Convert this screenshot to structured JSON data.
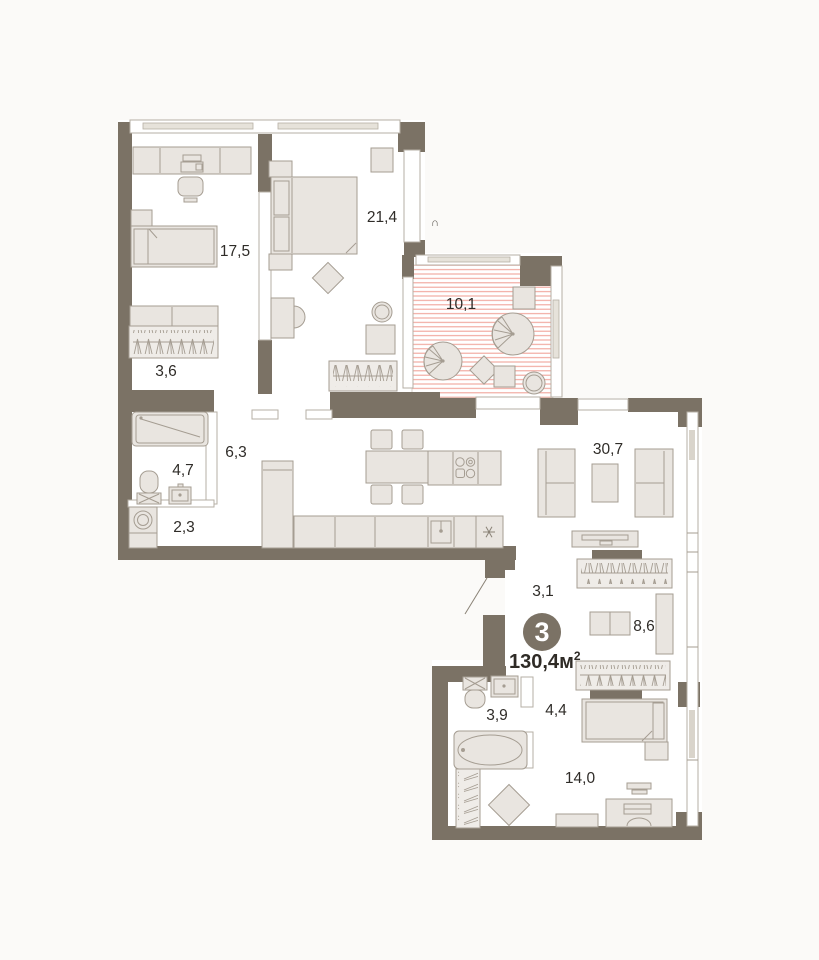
{
  "page": {
    "background": "#fbfaf8"
  },
  "plan": {
    "type": "apartment-floor-plan",
    "badge": {
      "rooms_count": "3",
      "area_value": "130,4",
      "area_unit": "м",
      "area_sup": "2"
    },
    "rooms": [
      {
        "id": "bedroom-kids",
        "area": "17,5"
      },
      {
        "id": "bedroom-master",
        "area": "21,4"
      },
      {
        "id": "wardrobe-kids",
        "area": "3,6"
      },
      {
        "id": "balcony",
        "area": "10,1"
      },
      {
        "id": "hallway",
        "area": "6,3"
      },
      {
        "id": "bathroom-main",
        "area": "4,7"
      },
      {
        "id": "laundry",
        "area": "2,3"
      },
      {
        "id": "living-kitchen",
        "area": "30,7"
      },
      {
        "id": "corridor",
        "area": "3,1"
      },
      {
        "id": "wardrobe-hall",
        "area": "8,6"
      },
      {
        "id": "bathroom-second",
        "area": "3,9"
      },
      {
        "id": "hall-small",
        "area": "4,4"
      },
      {
        "id": "bedroom-third",
        "area": "14,0"
      }
    ],
    "colors": {
      "wall": "#7b7265",
      "furniture_fill": "#e9e5e0",
      "furniture_stroke": "#a59d92",
      "balcony_hatch": "#f0a49a",
      "label_text": "#2f2c28",
      "badge_fill": "#7b7265",
      "badge_text": "#ffffff"
    },
    "window_vent_symbol": "∩"
  }
}
